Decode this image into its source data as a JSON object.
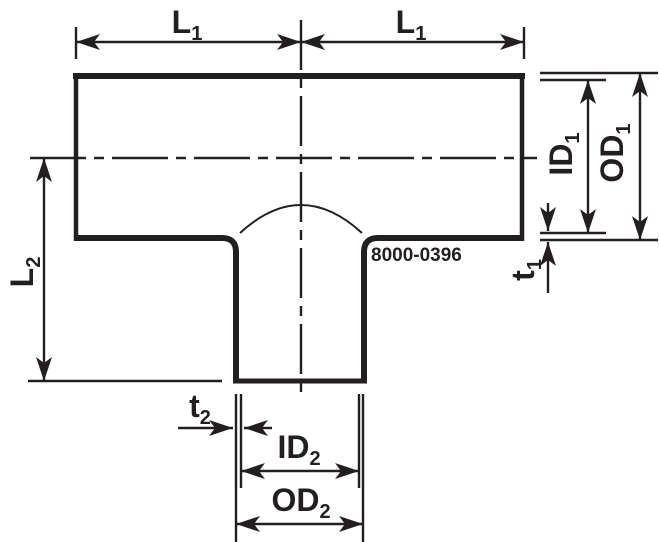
{
  "canvas": {
    "width": 659,
    "height": 542,
    "background": "#ffffff",
    "ink_color": "#231f20"
  },
  "drawing": {
    "kind": "pipe-tee-dimension-drawing",
    "part_number": "8000-0396"
  },
  "dimension_labels": {
    "L1_left": {
      "base": "L",
      "sub": "1"
    },
    "L1_right": {
      "base": "L",
      "sub": "1"
    },
    "ID1": {
      "base": "ID",
      "sub": "1"
    },
    "OD1": {
      "base": "OD",
      "sub": "1"
    },
    "t1": {
      "base": "t",
      "sub": "1"
    },
    "L2": {
      "base": "L",
      "sub": "2"
    },
    "t2": {
      "base": "t",
      "sub": "2"
    },
    "ID2": {
      "base": "ID",
      "sub": "2"
    },
    "OD2": {
      "base": "OD",
      "sub": "2"
    }
  }
}
